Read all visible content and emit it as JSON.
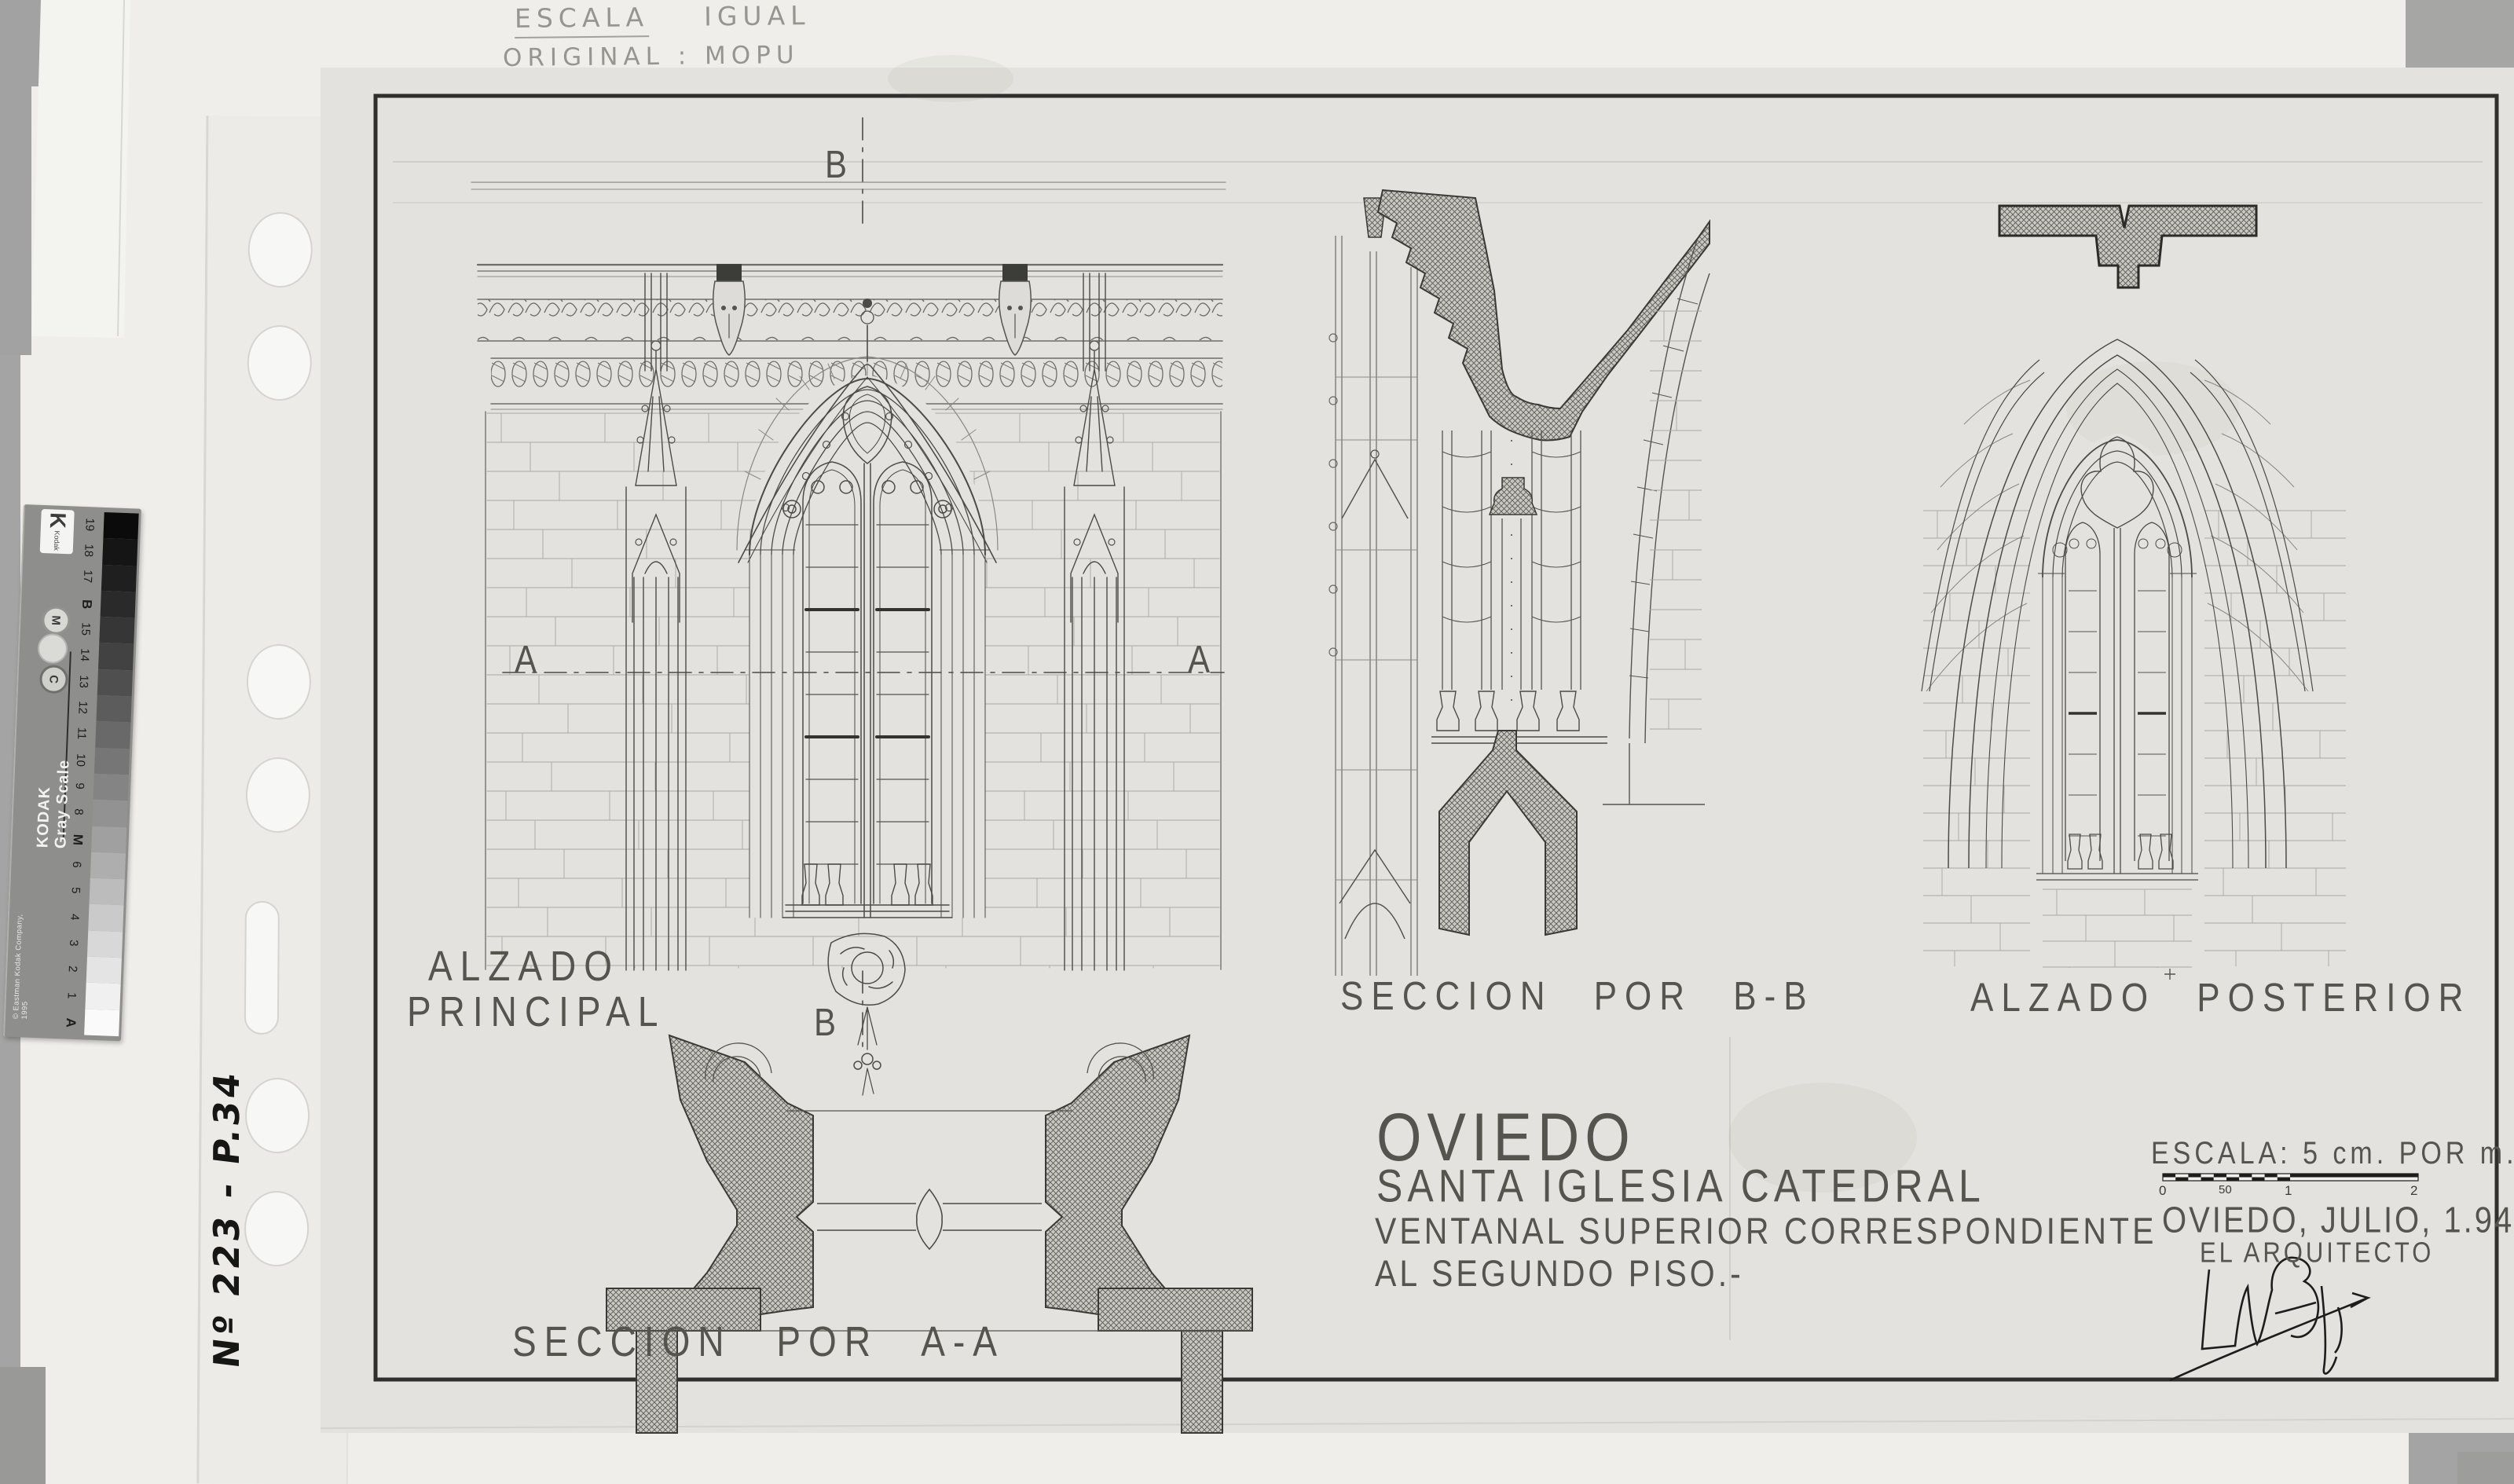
{
  "annotations": {
    "top_note_word1": "ESCALA",
    "top_note_word2": "IGUAL",
    "top_note_line2": "ORIGINAL : MOPU",
    "side_marker": "Nº 223 - P.34"
  },
  "kodak_scale": {
    "brand": "KODAK Gray Scale",
    "copyright": "© Eastman Kodak Company, 1995",
    "logo_text": "Kodak",
    "logo_letter": "K",
    "control_letters": {
      "c": "C",
      "m": "M"
    },
    "labels": [
      "19",
      "18",
      "17",
      "B",
      "15",
      "14",
      "13",
      "12",
      "11",
      "10",
      "9",
      "8",
      "M",
      "6",
      "5",
      "4",
      "3",
      "2",
      "1",
      "A"
    ]
  },
  "drawing_labels": {
    "alzado_principal_line1": "ALZADO",
    "alzado_principal_line2": "PRINCIPAL",
    "seccion_bb": "SECCION POR B-B",
    "alzado_posterior": "ALZADO POSTERIOR",
    "seccion_aa": "SECCION POR A-A",
    "section_a_left": "A",
    "section_a_right": "A",
    "section_b_top": "B",
    "section_b_bottom": "B"
  },
  "title_block": {
    "city": "OVIEDO",
    "building": "SANTA IGLESIA CATEDRAL",
    "subject_line1": "VENTANAL SUPERIOR CORRESPONDIENTE",
    "subject_line2": "AL SEGUNDO PISO.-"
  },
  "scale_block": {
    "scale_text": "ESCALA: 5 cm. POR m.",
    "bar_labels": [
      "0",
      "50",
      "1",
      "2"
    ],
    "date_line": "OVIEDO, JULIO, 1.944",
    "architect_line": "EL ARQUITECTO"
  },
  "colors": {
    "photo_background": "#a4a4a4",
    "backing_paper": "#efeeea",
    "drawing_sheet": "#e3e2de",
    "ink": "#3f3e3a",
    "frame": "#2f2f2d",
    "pencil": "#97958f"
  }
}
